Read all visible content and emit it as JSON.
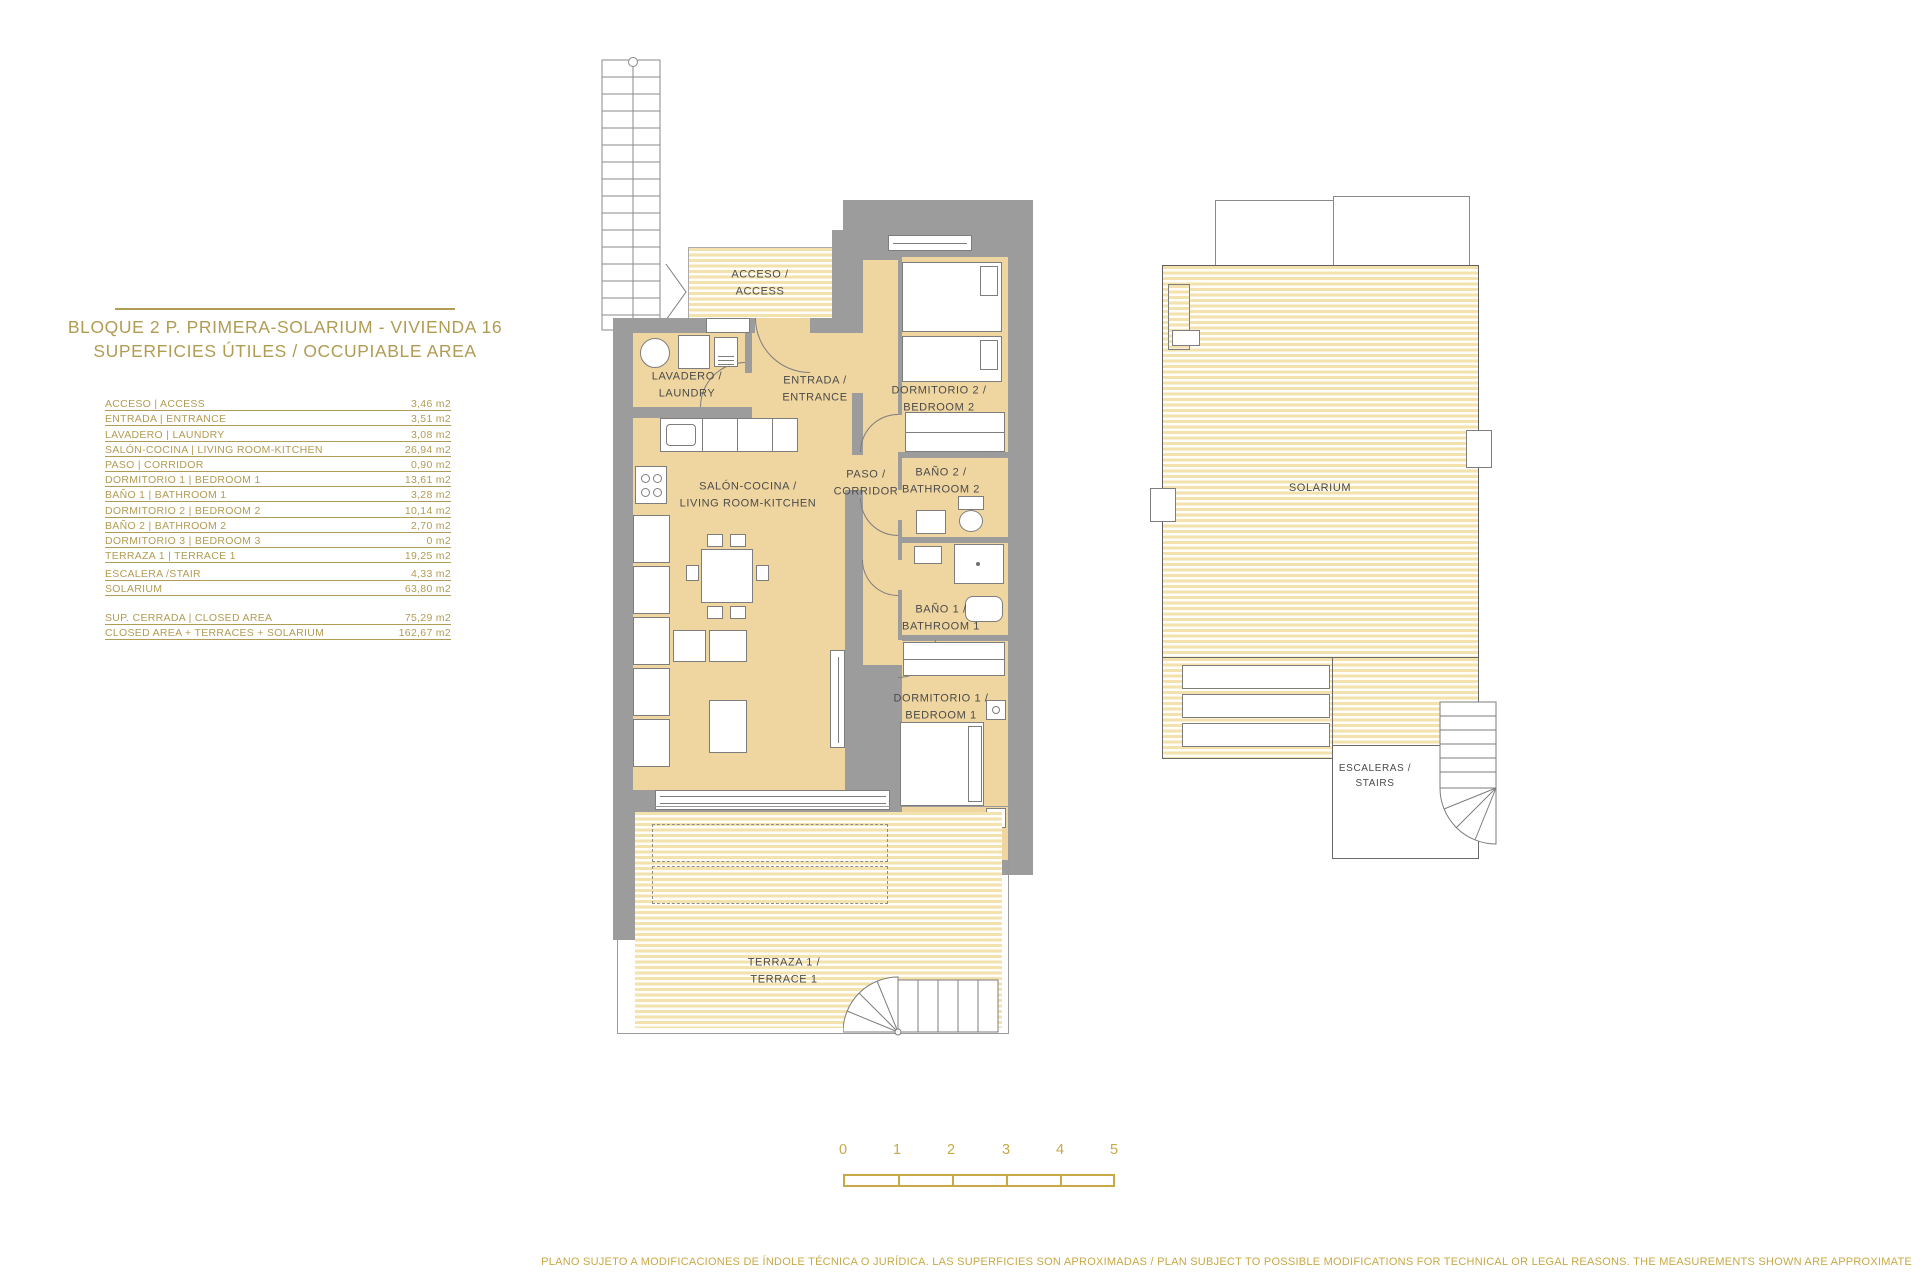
{
  "colors": {
    "gold": "#b19c53",
    "gold_bright": "#c7a945",
    "tan": "#efd5a0",
    "stripe": "#f3e1ae",
    "wall": "#9c9c9c",
    "ink": "#4b4b4b"
  },
  "header": {
    "title_line1": "BLOQUE 2 P. PRIMERA-SOLARIUM - VIVIENDA 16",
    "title_line2": "SUPERFICIES ÚTILES / OCCUPIABLE AREA"
  },
  "area_table": {
    "rows": [
      {
        "label": "ACCESO | ACCESS",
        "value": "3,46 m2"
      },
      {
        "label": "ENTRADA | ENTRANCE",
        "value": "3,51 m2"
      },
      {
        "label": "LAVADERO | LAUNDRY",
        "value": "3,08 m2"
      },
      {
        "label": "SALÓN-COCINA | LIVING ROOM-KITCHEN",
        "value": "26,94 m2"
      },
      {
        "label": "PASO | CORRIDOR",
        "value": "0,90 m2"
      },
      {
        "label": "DORMITORIO 1 | BEDROOM 1",
        "value": "13,61 m2"
      },
      {
        "label": "BAÑO 1 | BATHROOM 1",
        "value": "3,28 m2"
      },
      {
        "label": "DORMITORIO 2 | BEDROOM 2",
        "value": "10,14 m2"
      },
      {
        "label": "BAÑO 2 | BATHROOM 2",
        "value": "2,70 m2"
      },
      {
        "label": "DORMITORIO 3 | BEDROOM 3",
        "value": "0 m2"
      },
      {
        "label": "TERRAZA 1 | TERRACE 1",
        "value": "19,25 m2"
      }
    ],
    "stair_rows": [
      {
        "label": "ESCALERA /STAIR",
        "value": "4,33 m2"
      },
      {
        "label": "SOLARIUM",
        "value": "63,80 m2"
      }
    ],
    "summary_rows": [
      {
        "label": "SUP. CERRADA | CLOSED AREA",
        "value": "75,29 m2"
      },
      {
        "label": "CLOSED AREA + TERRACES + SOLARIUM",
        "value": "162,67 m2"
      }
    ]
  },
  "plan": {
    "labels": {
      "acceso": {
        "l1": "ACCESO /",
        "l2": "ACCESS"
      },
      "lavadero": {
        "l1": "LAVADERO /",
        "l2": "LAUNDRY"
      },
      "entrada": {
        "l1": "ENTRADA /",
        "l2": "ENTRANCE"
      },
      "dormitorio2": {
        "l1": "DORMITORIO 2 /",
        "l2": "BEDROOM 2"
      },
      "paso": {
        "l1": "PASO /",
        "l2": "CORRIDOR"
      },
      "bano2": {
        "l1": "BAÑO 2 /",
        "l2": "BATHROOM 2"
      },
      "salon": {
        "l1": "SALÓN-COCINA /",
        "l2": "LIVING ROOM-KITCHEN"
      },
      "bano1": {
        "l1": "BAÑO 1 /",
        "l2": "BATHROOM 1"
      },
      "dormitorio1": {
        "l1": "DORMITORIO 1 /",
        "l2": "BEDROOM 1"
      },
      "terraza": {
        "l1": "TERRAZA 1 /",
        "l2": "TERRACE 1"
      }
    }
  },
  "solarium_plan": {
    "labels": {
      "solarium": "SOLARIUM",
      "escaleras": {
        "l1": "ESCALERAS /",
        "l2": "STAIRS"
      }
    }
  },
  "scale_bar": {
    "ticks": [
      "0",
      "1",
      "2",
      "3",
      "4",
      "5"
    ]
  },
  "footer": {
    "disclaimer": "PLANO SUJETO A MODIFICACIONES DE ÍNDOLE TÉCNICA O JURÍDICA. LAS SUPERFICIES SON APROXIMADAS / PLAN SUBJECT TO POSSIBLE MODIFICATIONS FOR TECHNICAL OR LEGAL REASONS. THE MEASUREMENTS SHOWN ARE APPROXIMATE"
  }
}
